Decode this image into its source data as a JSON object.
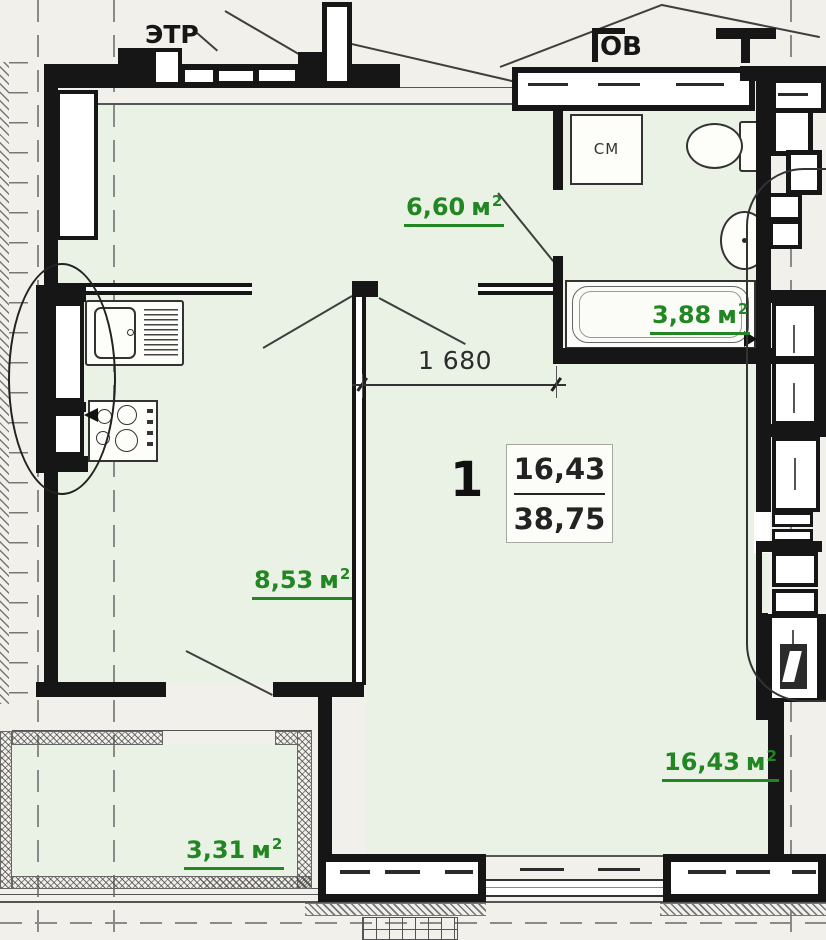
{
  "plan": {
    "title_labels": {
      "etr": "ЭТР",
      "ov": "ОВ",
      "washer": "СМ"
    },
    "unit": "м",
    "unit_sup": "2",
    "rooms": [
      {
        "name": "hallway",
        "area": "6,60"
      },
      {
        "name": "bathroom",
        "area": "3,88"
      },
      {
        "name": "kitchen",
        "area": "8,53"
      },
      {
        "name": "living-room",
        "area": "16,43"
      },
      {
        "name": "balcony",
        "area": "3,31"
      }
    ],
    "dimension_mm": "1 680",
    "apartment": {
      "number": "1",
      "living_area": "16,43",
      "total_area": "38,75"
    },
    "colors": {
      "area_label_green": "#228622",
      "wall_black": "#161616",
      "floor_green": "#eaf2e5"
    }
  }
}
